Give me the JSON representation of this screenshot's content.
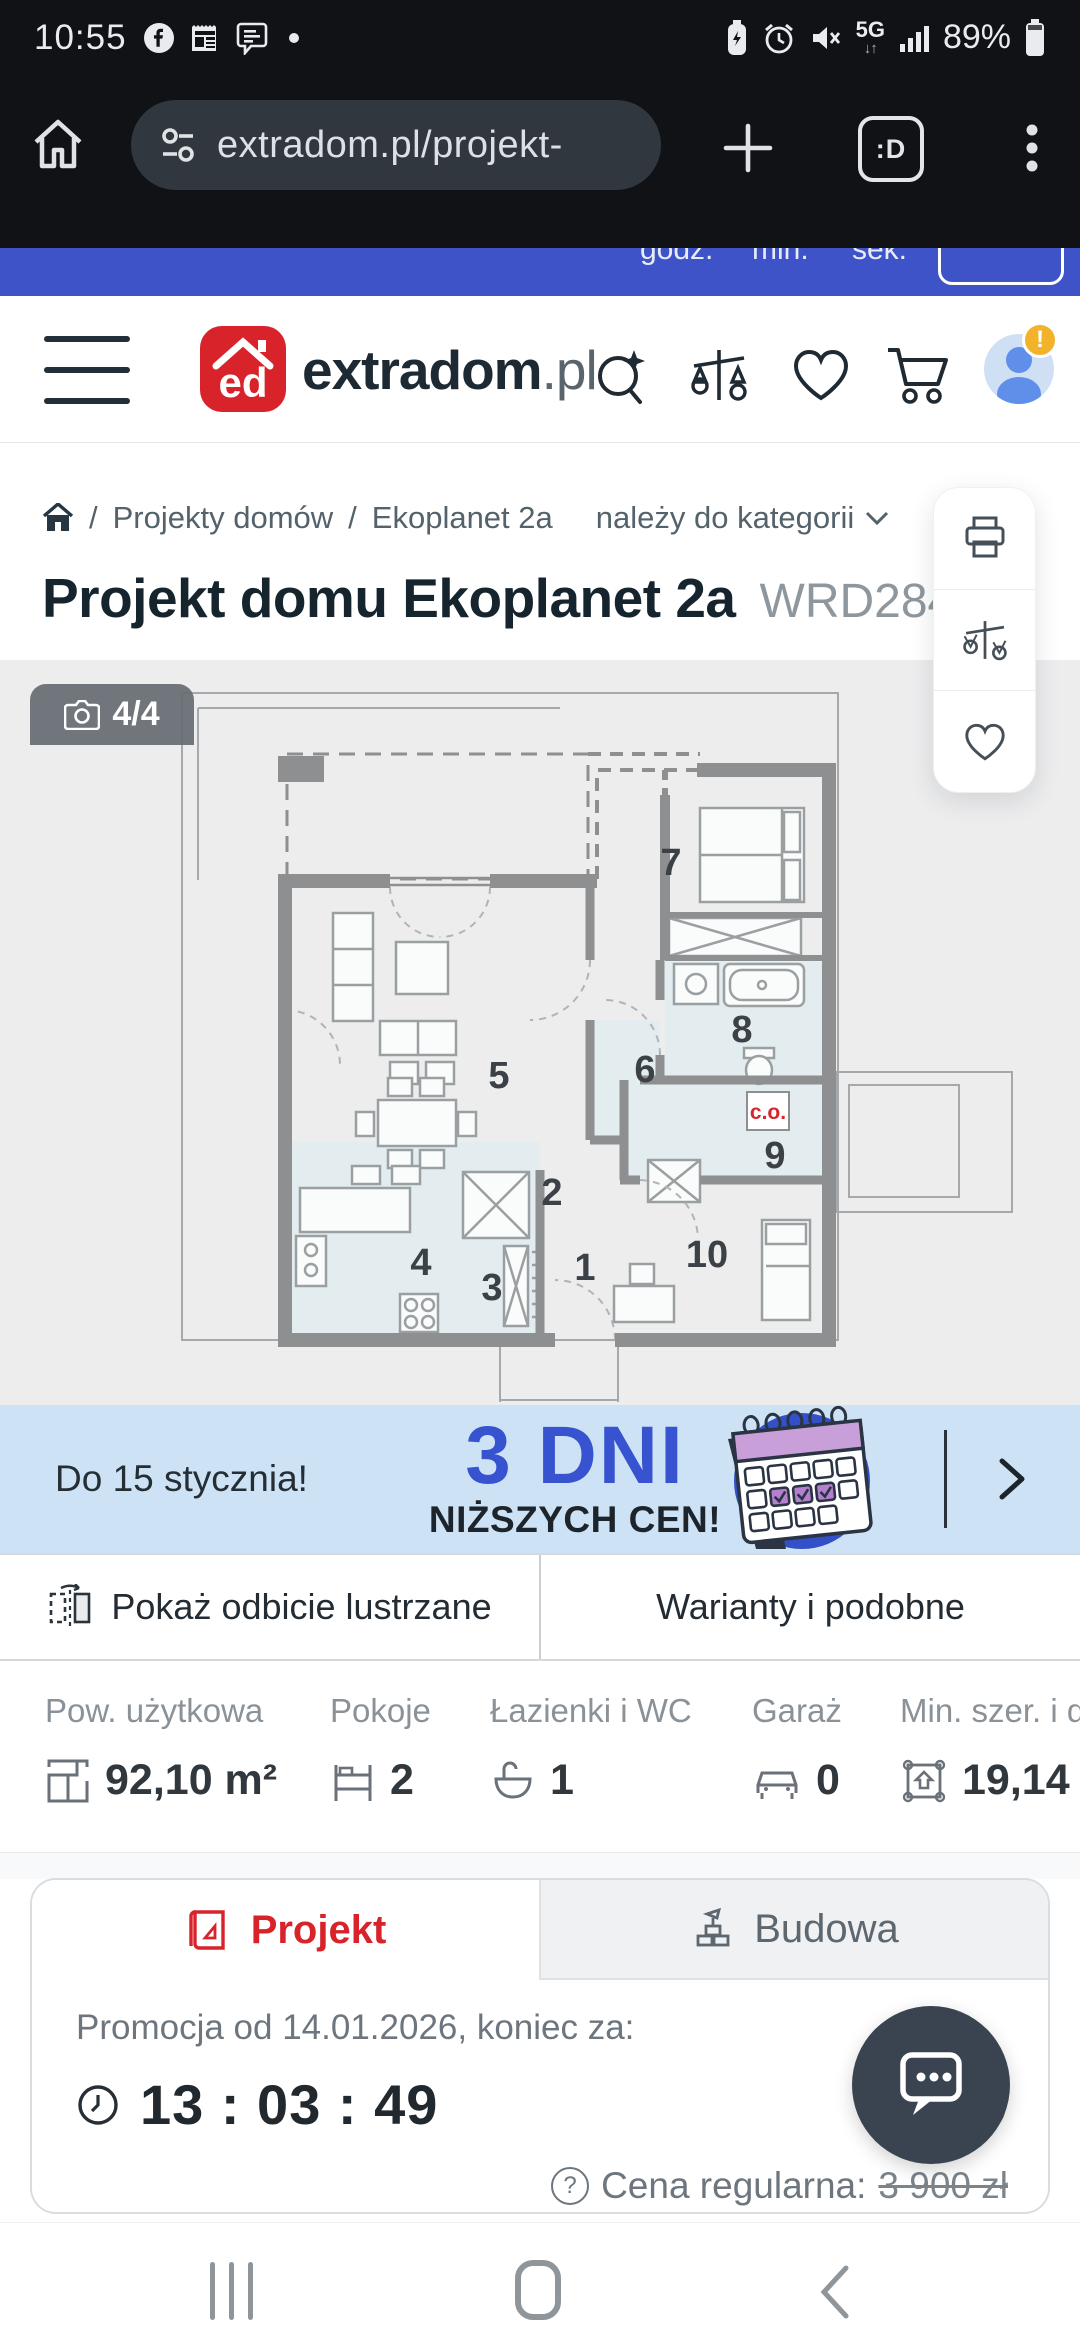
{
  "status_bar": {
    "time": "10:55",
    "battery_pct": "89%",
    "network": "5G",
    "net_arrows": "↓↑"
  },
  "browser_bar": {
    "url": "extradom.pl/projekt-",
    "tab_badge": ":D"
  },
  "countdown_strip": {
    "unit_hours": "godz.",
    "unit_minutes": "min.",
    "unit_seconds": "sek."
  },
  "header": {
    "logo_mark": "ed",
    "logo_name": "extradom",
    "logo_tld": ".pl",
    "avatar_alert": "!"
  },
  "breadcrumb": {
    "sep1": "/",
    "item1": "Projekty domów",
    "sep2": "/",
    "item2": "Ekoplanet 2a",
    "category_link": "należy do kategorii"
  },
  "title": {
    "main": "Projekt domu Ekoplanet 2a",
    "code": "WRD284"
  },
  "floorplan": {
    "photo_counter": "4/4",
    "co_label": "c.o.",
    "rooms": {
      "r1": "1",
      "r2": "2",
      "r3": "3",
      "r4": "4",
      "r5": "5",
      "r6": "6",
      "r7": "7",
      "r8": "8",
      "r9": "9",
      "r10": "10"
    }
  },
  "promo": {
    "deadline": "Do 15 stycznia!",
    "headline": "3 DNI",
    "subline": "NIŻSZYCH CEN!"
  },
  "actions": {
    "mirror_label": "Pokaż odbicie lustrzane",
    "variants_label": "Warianty i podobne"
  },
  "stats": {
    "columns": [
      {
        "label": "Pow. użytkowa",
        "value": "92,10 m²",
        "icon": "floor-area-icon"
      },
      {
        "label": "Pokoje",
        "value": "2",
        "icon": "bed-icon"
      },
      {
        "label": "Łazienki i WC",
        "value": "1",
        "icon": "bathtub-icon"
      },
      {
        "label": "Garaż",
        "value": "0",
        "icon": "car-icon"
      },
      {
        "label": "Min. szer. i dł",
        "value": "19,14 x",
        "icon": "plot-icon"
      }
    ]
  },
  "offer_card": {
    "tab_project": "Projekt",
    "tab_build": "Budowa",
    "promo_info": "Promocja od 14.01.2026, koniec za:",
    "countdown": "13 : 03 : 49",
    "price_visible": "3 40",
    "regular_hint": "?",
    "regular_label": "Cena regularna:",
    "regular_price": "3 900 zł"
  },
  "colors": {
    "brand_red": "#d8232a",
    "promo_blue": "#3753cf",
    "strip_blue": "#3e53c7",
    "price_red": "#e02228"
  }
}
